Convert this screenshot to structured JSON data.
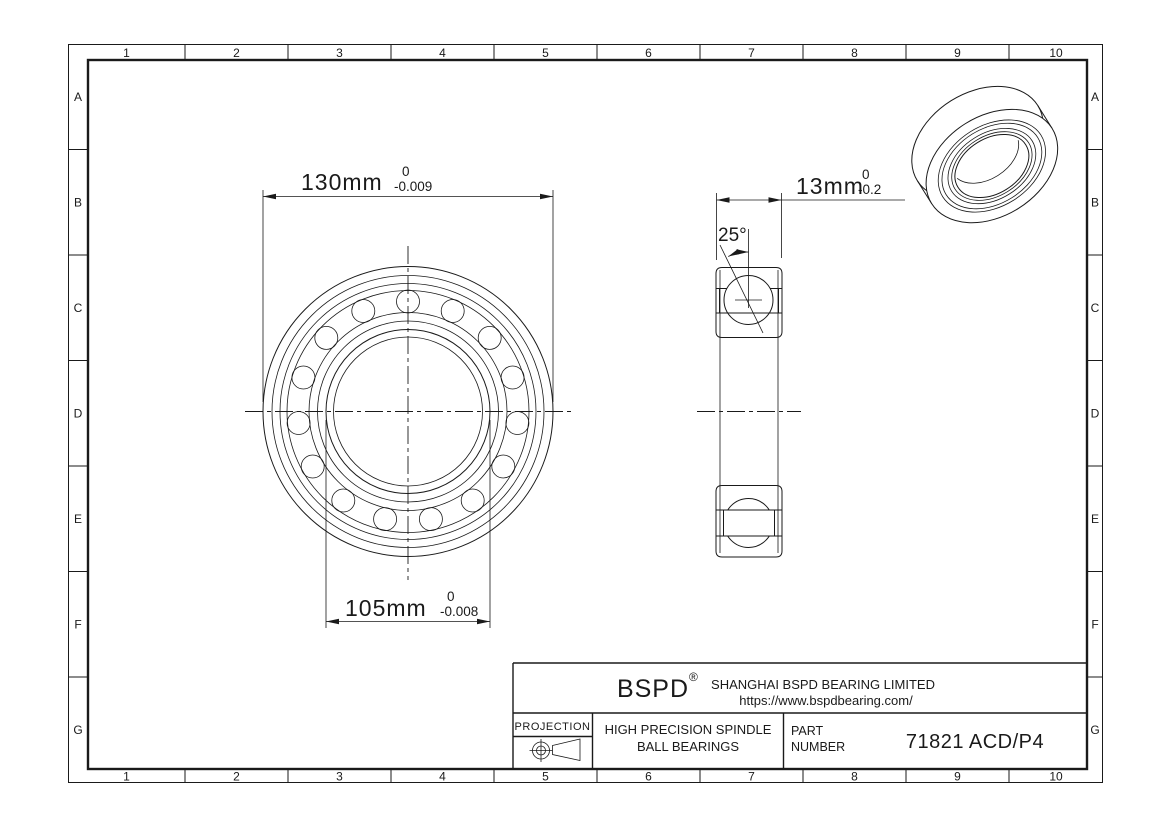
{
  "grid": {
    "columns": [
      "1",
      "2",
      "3",
      "4",
      "5",
      "6",
      "7",
      "8",
      "9",
      "10"
    ],
    "rows": [
      "A",
      "B",
      "C",
      "D",
      "E",
      "F",
      "G"
    ]
  },
  "dimensions": {
    "outer_diameter": {
      "value": "130mm",
      "tolerance_upper": "0",
      "tolerance_lower": "-0.009"
    },
    "bore_diameter": {
      "value": "105mm",
      "tolerance_upper": "0",
      "tolerance_lower": "-0.008"
    },
    "width": {
      "value": "13mm",
      "tolerance_upper": "0",
      "tolerance_lower": "-0.2"
    },
    "contact_angle": "25°"
  },
  "title_block": {
    "logo": "BSPD",
    "registered_mark": "®",
    "company": "SHANGHAI BSPD BEARING LIMITED",
    "website": "https://www.bspdbearing.com/",
    "projection_label": "PROJECTION",
    "product_line1": "HIGH  PRECISION SPINDLE",
    "product_line2": "BALL BEARINGS",
    "part_label_line1": "PART",
    "part_label_line2": "NUMBER",
    "part_number": "71821 ACD/P4"
  },
  "colors": {
    "line": "#1a1a1a",
    "background": "#ffffff"
  }
}
